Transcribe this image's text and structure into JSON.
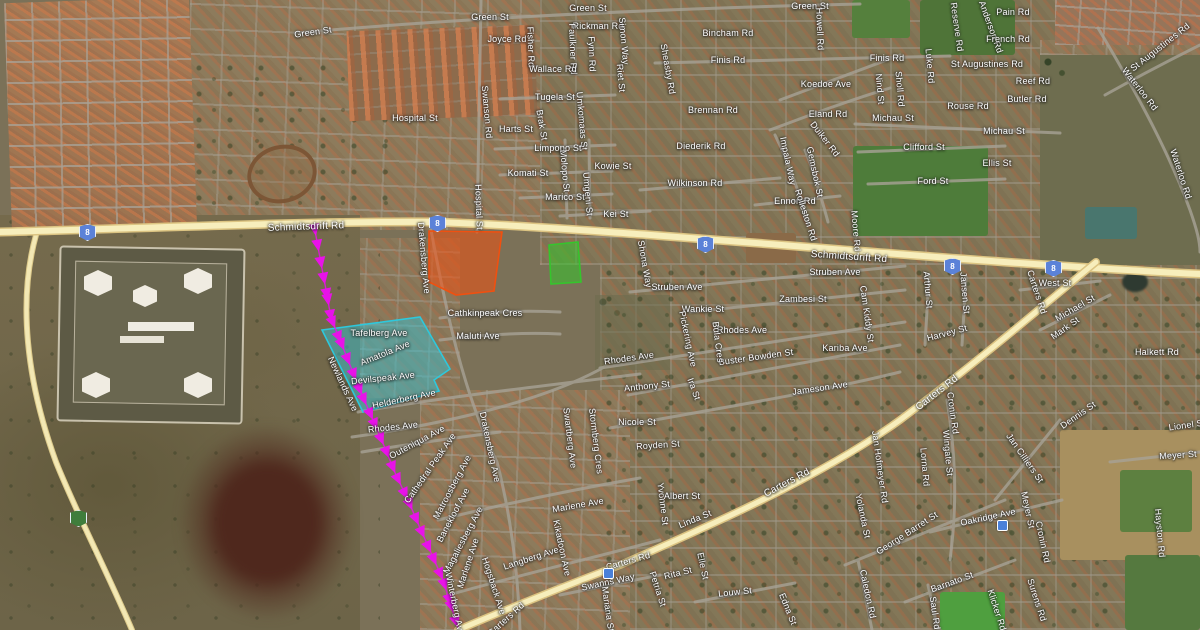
{
  "map": {
    "kind": "satellite-map-with-annotations",
    "colors": {
      "highlight_cyan": "#2ec8dc",
      "highlight_orange": "#f05010",
      "highlight_green": "#35c52c",
      "route_magenta": "#e812e8",
      "road_yellow": "#f7eebc",
      "shield_blue": "#5b82d8",
      "shield_green": "#3f7d3c"
    }
  },
  "route_shields": [
    {
      "label": "8",
      "x": 87,
      "y": 232,
      "color": "blue"
    },
    {
      "label": "8",
      "x": 437,
      "y": 223,
      "color": "blue"
    },
    {
      "label": "8",
      "x": 705,
      "y": 244,
      "color": "blue"
    },
    {
      "label": "8",
      "x": 952,
      "y": 266,
      "color": "blue"
    },
    {
      "label": "8",
      "x": 1053,
      "y": 268,
      "color": "blue"
    },
    {
      "label": "",
      "x": 78,
      "y": 518,
      "color": "green"
    }
  ],
  "poi_markers": [
    {
      "x": 608,
      "y": 573
    },
    {
      "x": 1002,
      "y": 525
    }
  ],
  "annotations": {
    "magenta_route": {
      "style": "arrow-chain",
      "points": [
        [
          314,
          225
        ],
        [
          320,
          258
        ],
        [
          327,
          295
        ],
        [
          331,
          318
        ],
        [
          340,
          340
        ],
        [
          352,
          370
        ],
        [
          362,
          395
        ],
        [
          373,
          420
        ],
        [
          385,
          448
        ],
        [
          396,
          475
        ],
        [
          408,
          500
        ],
        [
          420,
          528
        ],
        [
          432,
          555
        ],
        [
          443,
          580
        ],
        [
          450,
          602
        ],
        [
          458,
          628
        ]
      ]
    },
    "cyan_area": {
      "points": [
        [
          322,
          330
        ],
        [
          420,
          317
        ],
        [
          450,
          369
        ],
        [
          434,
          380
        ],
        [
          439,
          391
        ],
        [
          363,
          412
        ]
      ]
    },
    "orange_area": {
      "points": [
        [
          429,
          231
        ],
        [
          502,
          232
        ],
        [
          494,
          291
        ],
        [
          456,
          295
        ],
        [
          429,
          282
        ]
      ]
    },
    "green_area": {
      "points": [
        [
          549,
          245
        ],
        [
          578,
          242
        ],
        [
          581,
          282
        ],
        [
          551,
          284
        ]
      ]
    }
  },
  "street_labels": [
    [
      "Green St",
      313,
      32,
      -8
    ],
    [
      "Green St",
      490,
      17,
      0
    ],
    [
      "Green St",
      588,
      8,
      0
    ],
    [
      "Green St",
      810,
      6,
      0
    ],
    [
      "Joyce Rd",
      507,
      39,
      0
    ],
    [
      "Fisher Rd",
      531,
      47,
      88
    ],
    [
      "Rickman Rd",
      598,
      26,
      0
    ],
    [
      "Faulkner Rd",
      573,
      49,
      88
    ],
    [
      "Fynn Rd",
      592,
      54,
      88
    ],
    [
      "Wallace Rd",
      553,
      69,
      0
    ],
    [
      "Bincham Rd",
      728,
      33,
      0
    ],
    [
      "Pain Rd",
      1013,
      12,
      0
    ],
    [
      "Reserve Rd",
      957,
      27,
      82
    ],
    [
      "Anderson Rd",
      991,
      27,
      70
    ],
    [
      "French Rd",
      1008,
      39,
      0
    ],
    [
      "Finis Rd",
      728,
      60,
      0
    ],
    [
      "Finis Rd",
      887,
      58,
      0
    ],
    [
      "St Augustines Rd",
      987,
      64,
      0
    ],
    [
      "St Augustines Rd",
      1160,
      47,
      -38
    ],
    [
      "Luke Rd",
      930,
      66,
      85
    ],
    [
      "Howell Rd",
      820,
      29,
      88
    ],
    [
      "Hospital St",
      415,
      118,
      0
    ],
    [
      "Swanson Rd",
      487,
      112,
      85
    ],
    [
      "Tugela St",
      555,
      97,
      0
    ],
    [
      "Umkomaas St",
      582,
      121,
      85
    ],
    [
      "Harts St",
      516,
      129,
      0
    ],
    [
      "Brak St",
      542,
      125,
      80
    ],
    [
      "Koedoe Ave",
      826,
      84,
      0
    ],
    [
      "Nind St",
      880,
      89,
      85
    ],
    [
      "Sholl Rd",
      900,
      89,
      85
    ],
    [
      "Reef Rd",
      1033,
      81,
      0
    ],
    [
      "Butler Rd",
      1027,
      99,
      0
    ],
    [
      "Rouse Rd",
      968,
      106,
      0
    ],
    [
      "Limpopo St",
      558,
      148,
      0
    ],
    [
      "Kowie St",
      613,
      166,
      0
    ],
    [
      "Molopo St",
      565,
      171,
      85
    ],
    [
      "Komati St",
      528,
      173,
      0
    ],
    [
      "Brennan Rd",
      713,
      110,
      0
    ],
    [
      "Eland Rd",
      828,
      114,
      0
    ],
    [
      "Michau St",
      893,
      118,
      0
    ],
    [
      "Michau St",
      1004,
      131,
      0
    ],
    [
      "Clifford St",
      924,
      147,
      0
    ],
    [
      "Ellis St",
      997,
      163,
      0
    ],
    [
      "Diederik Rd",
      701,
      146,
      0
    ],
    [
      "Duiker Rd",
      825,
      139,
      52
    ],
    [
      "Impala Way",
      788,
      161,
      78
    ],
    [
      "Gemsbok St",
      815,
      172,
      78
    ],
    [
      "Wilkinson Rd",
      695,
      183,
      0
    ],
    [
      "Marico St",
      565,
      197,
      0
    ],
    [
      "Umgeni St",
      588,
      194,
      85
    ],
    [
      "Kei St",
      616,
      214,
      0
    ],
    [
      "Ford St",
      933,
      181,
      0
    ],
    [
      "Ennon Rd",
      795,
      201,
      0
    ],
    [
      "Rolleston Rd",
      806,
      215,
      72
    ],
    [
      "Moore Rd",
      856,
      231,
      85
    ],
    [
      "Hospital St",
      479,
      207,
      88
    ],
    [
      "Waterloo Rd",
      1140,
      89,
      52
    ],
    [
      "Waterloo Rd",
      1181,
      174,
      72
    ],
    [
      "Sheasby Rd",
      668,
      69,
      80
    ],
    [
      "Riet St",
      621,
      78,
      85
    ],
    [
      "Simon Way",
      624,
      41,
      85
    ],
    [
      "Shona Way",
      645,
      264,
      80
    ],
    [
      "Schmidtsdrift Rd",
      306,
      227,
      -2,
      10
    ],
    [
      "Schmidtsdrift Rd",
      849,
      257,
      4,
      10
    ],
    [
      "Drakensberg Ave",
      424,
      258,
      85
    ],
    [
      "Drakensberg Ave",
      490,
      447,
      78
    ],
    [
      "Cathkinpeak Cres",
      485,
      313,
      0
    ],
    [
      "Maluti Ave",
      478,
      336,
      0
    ],
    [
      "Tafelberg Ave",
      379,
      333,
      0
    ],
    [
      "Amatola Ave",
      385,
      353,
      -22
    ],
    [
      "Devilspeak Ave",
      383,
      378,
      -6
    ],
    [
      "Helderberg Ave",
      404,
      399,
      -12
    ],
    [
      "Newlands Ave",
      343,
      384,
      65
    ],
    [
      "Rhodes Ave",
      393,
      427,
      -6
    ],
    [
      "Outeniqua Ave",
      417,
      442,
      -28
    ],
    [
      "Cathedral Peak Ave",
      430,
      468,
      -55
    ],
    [
      "Matroosberg Ave",
      452,
      487,
      -62
    ],
    [
      "Banekloof Ave",
      453,
      515,
      -62
    ],
    [
      "Magaliesberg Ave",
      463,
      540,
      -62
    ],
    [
      "Marlene Ave",
      468,
      563,
      -72
    ],
    [
      "Marlene Ave",
      578,
      505,
      -10
    ],
    [
      "Langberg Ave",
      531,
      558,
      -18
    ],
    [
      "Kikadoon Ave",
      562,
      548,
      78
    ],
    [
      "Hogsback Ave",
      494,
      586,
      72
    ],
    [
      "Winterberg Ave",
      455,
      604,
      78
    ],
    [
      "Swartberg Ave",
      570,
      438,
      83
    ],
    [
      "Stormberg Cres",
      596,
      441,
      83
    ],
    [
      "Nicole St",
      637,
      422,
      0
    ],
    [
      "Royden St",
      658,
      445,
      -4
    ],
    [
      "Yvonne St",
      663,
      504,
      83
    ],
    [
      "Albert St",
      682,
      496,
      0
    ],
    [
      "Linda St",
      695,
      519,
      -22
    ],
    [
      "Rhodes Ave",
      629,
      358,
      -8
    ],
    [
      "Rhodes Ave",
      742,
      330,
      0
    ],
    [
      "Struben Ave",
      835,
      272,
      0
    ],
    [
      "Struben Ave",
      677,
      287,
      0
    ],
    [
      "Zambesi St",
      803,
      299,
      0
    ],
    [
      "Wankie St",
      703,
      309,
      0
    ],
    [
      "Kariba Ave",
      845,
      348,
      0
    ],
    [
      "Buster Bowden St",
      756,
      357,
      -8
    ],
    [
      "Cam Kiddy St",
      867,
      314,
      82
    ],
    [
      "Pickering Ave",
      688,
      339,
      78
    ],
    [
      "Bula Cres",
      718,
      342,
      83
    ],
    [
      "Arthur St",
      928,
      290,
      85
    ],
    [
      "Jansen St",
      965,
      293,
      85
    ],
    [
      "Harvey St",
      947,
      333,
      -15
    ],
    [
      "Anthony St",
      647,
      386,
      -6
    ],
    [
      "Ira St",
      694,
      389,
      70
    ],
    [
      "Jameson Ave",
      820,
      388,
      -8
    ],
    [
      "West St",
      1055,
      283,
      0
    ],
    [
      "Michael St",
      1075,
      308,
      -30
    ],
    [
      "Mark St",
      1065,
      328,
      -35
    ],
    [
      "Halkett Rd",
      1157,
      352,
      0
    ],
    [
      "Carters Rd",
      1037,
      292,
      72
    ],
    [
      "Carters Rd",
      937,
      393,
      -38,
      10
    ],
    [
      "Carters Rd",
      787,
      483,
      -28,
      10
    ],
    [
      "Carters Rd",
      628,
      561,
      -16
    ],
    [
      "Carters Rd",
      506,
      619,
      -42
    ],
    [
      "Swanns Way",
      608,
      582,
      -12
    ],
    [
      "Mariana St",
      608,
      609,
      82
    ],
    [
      "Petria St",
      658,
      589,
      72
    ],
    [
      "Rita St",
      678,
      573,
      -14
    ],
    [
      "Louw St",
      735,
      592,
      -6
    ],
    [
      "Edna St",
      788,
      609,
      68
    ],
    [
      "Elle St",
      703,
      566,
      78
    ],
    [
      "Meyer St",
      1178,
      455,
      -4
    ],
    [
      "Meyer St",
      1028,
      510,
      78
    ],
    [
      "Oakridge Ave",
      988,
      517,
      -12
    ],
    [
      "George Barret St",
      907,
      533,
      -33
    ],
    [
      "Barnato St",
      952,
      582,
      -20
    ],
    [
      "Yolanda St",
      863,
      516,
      78
    ],
    [
      "Jan Hofmeyer Rd",
      880,
      467,
      82
    ],
    [
      "Lorna Rd",
      925,
      467,
      85
    ],
    [
      "Wingate St",
      948,
      453,
      85
    ],
    [
      "Jan Cilliers St",
      1025,
      458,
      55
    ],
    [
      "Dennis St",
      1078,
      415,
      -35
    ],
    [
      "Cronin Rd",
      953,
      413,
      82
    ],
    [
      "Cronin Rd",
      1043,
      542,
      78
    ],
    [
      "Saul Rd",
      935,
      613,
      82
    ],
    [
      "Caledon Rd",
      868,
      594,
      78
    ],
    [
      "Klicker Rd",
      997,
      610,
      72
    ],
    [
      "Surens Rd",
      1037,
      600,
      72
    ],
    [
      "Hayston Rd",
      1160,
      533,
      85
    ],
    [
      "Lionel St",
      1187,
      425,
      -8
    ]
  ]
}
